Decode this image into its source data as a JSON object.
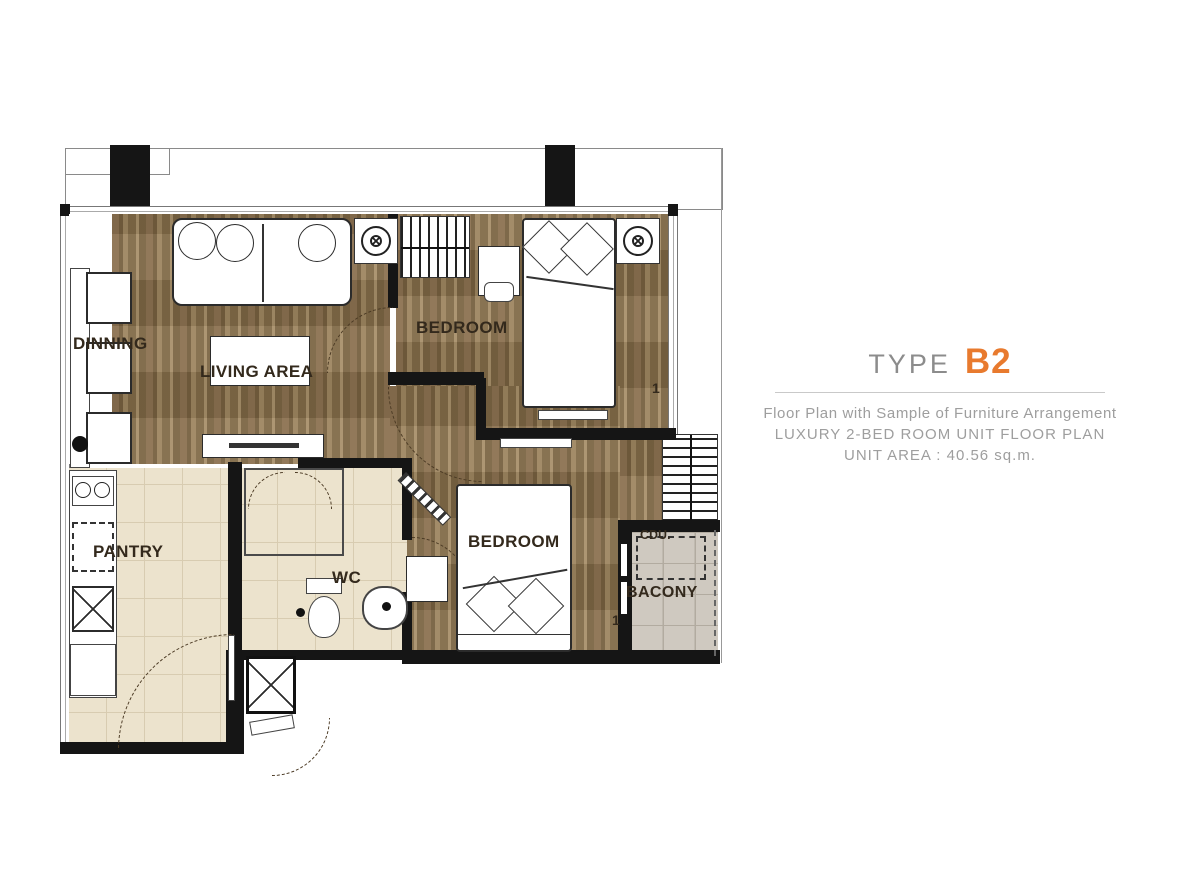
{
  "title": {
    "type_label": "TYPE",
    "type_code": "B2"
  },
  "description": {
    "line1": "Floor Plan with Sample of Furniture Arrangement",
    "line2": "LUXURY 2-BED ROOM UNIT FLOOR PLAN",
    "line3": "UNIT AREA : 40.56 sq.m."
  },
  "floor_plan": {
    "rooms": {
      "dining": "DINNING",
      "living": "LIVING AREA",
      "bedroom_top": "BEDROOM",
      "bedroom_bottom": "BEDROOM",
      "pantry": "PANTRY",
      "wc": "WC",
      "balcony": "BACONY",
      "cdu": "CDU.",
      "window_mark": "1"
    }
  },
  "colors": {
    "accent_orange": "#e87a2e",
    "wall_black": "#151515",
    "title_gray": "#8c8c8c",
    "subtitle_gray": "#9e9e9e",
    "wood_floor": "#8a6f4e",
    "tile_beige": "#ece3cd",
    "balcony_gray": "#cfc9c0"
  }
}
